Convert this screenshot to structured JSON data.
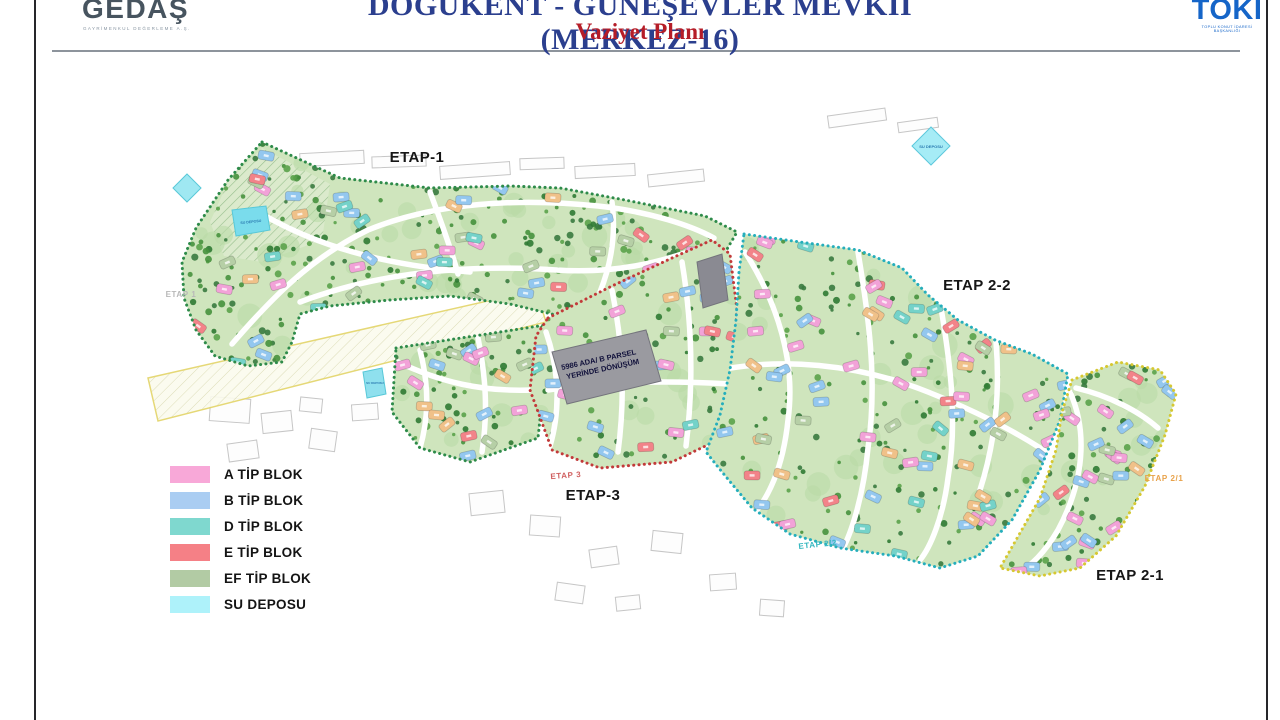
{
  "header": {
    "title": "DOĞUKENT - GÜNEŞEVLER MEVKİİ (MERKEZ-16)",
    "title_color": "#2b3f8e",
    "subtitle": "Vaziyet Planı",
    "subtitle_color": "#b51d28",
    "logo_left": {
      "name": "GEDAŞ",
      "caption": "GAYRİMENKUL DEĞERLEME A.Ş."
    },
    "logo_right": {
      "name": "TOKİ",
      "caption": "TOPLU KONUT İDARESİ BAŞKANLIĞI",
      "color": "#1565c8"
    }
  },
  "map": {
    "labels": {
      "etap1": "ETAP-1",
      "etap22": "ETAP 2-2",
      "etap3": "ETAP-3",
      "etap21": "ETAP 2-1",
      "faint_etap1": "ETAP 1",
      "faint_etap22": "ETAP 2/2",
      "faint_etap21": "ETAP 2/1",
      "faint_etap3": "ETAP 3"
    },
    "parcel_note_line1": "5986 ADA/ B PARSEL",
    "parcel_note_line2": "YERİNDE DÖNÜŞÜM",
    "water_label": "SU DEPOSU",
    "boundary_colors": {
      "etap1": "#2e8b4a",
      "etap3": "#c23a3a",
      "etap22": "#25aebc",
      "etap21": "#d6c832"
    }
  },
  "legend": {
    "items": [
      {
        "label": "A TİP BLOK",
        "color": "#f8a8d8"
      },
      {
        "label": "B TİP BLOK",
        "color": "#aacdf2"
      },
      {
        "label": "D TİP BLOK",
        "color": "#7fd8cf"
      },
      {
        "label": "E TİP BLOK",
        "color": "#f58086"
      },
      {
        "label": "EF TİP BLOK",
        "color": "#b2cba4"
      },
      {
        "label": "SU DEPOSU",
        "color": "#aef2fa"
      }
    ]
  },
  "palette": {
    "grass": "#cfe5bd",
    "tree_greens": [
      "#2f7a33",
      "#46913d",
      "#5aa24a",
      "#387a3f"
    ],
    "building_colors": [
      "#93c7ef",
      "#93c7ef",
      "#93c7ef",
      "#f2a2d8",
      "#f2a2d8",
      "#f28389",
      "#74d2c9",
      "#f0c189",
      "#b6cfa6"
    ],
    "water": "#9fe8f2"
  }
}
